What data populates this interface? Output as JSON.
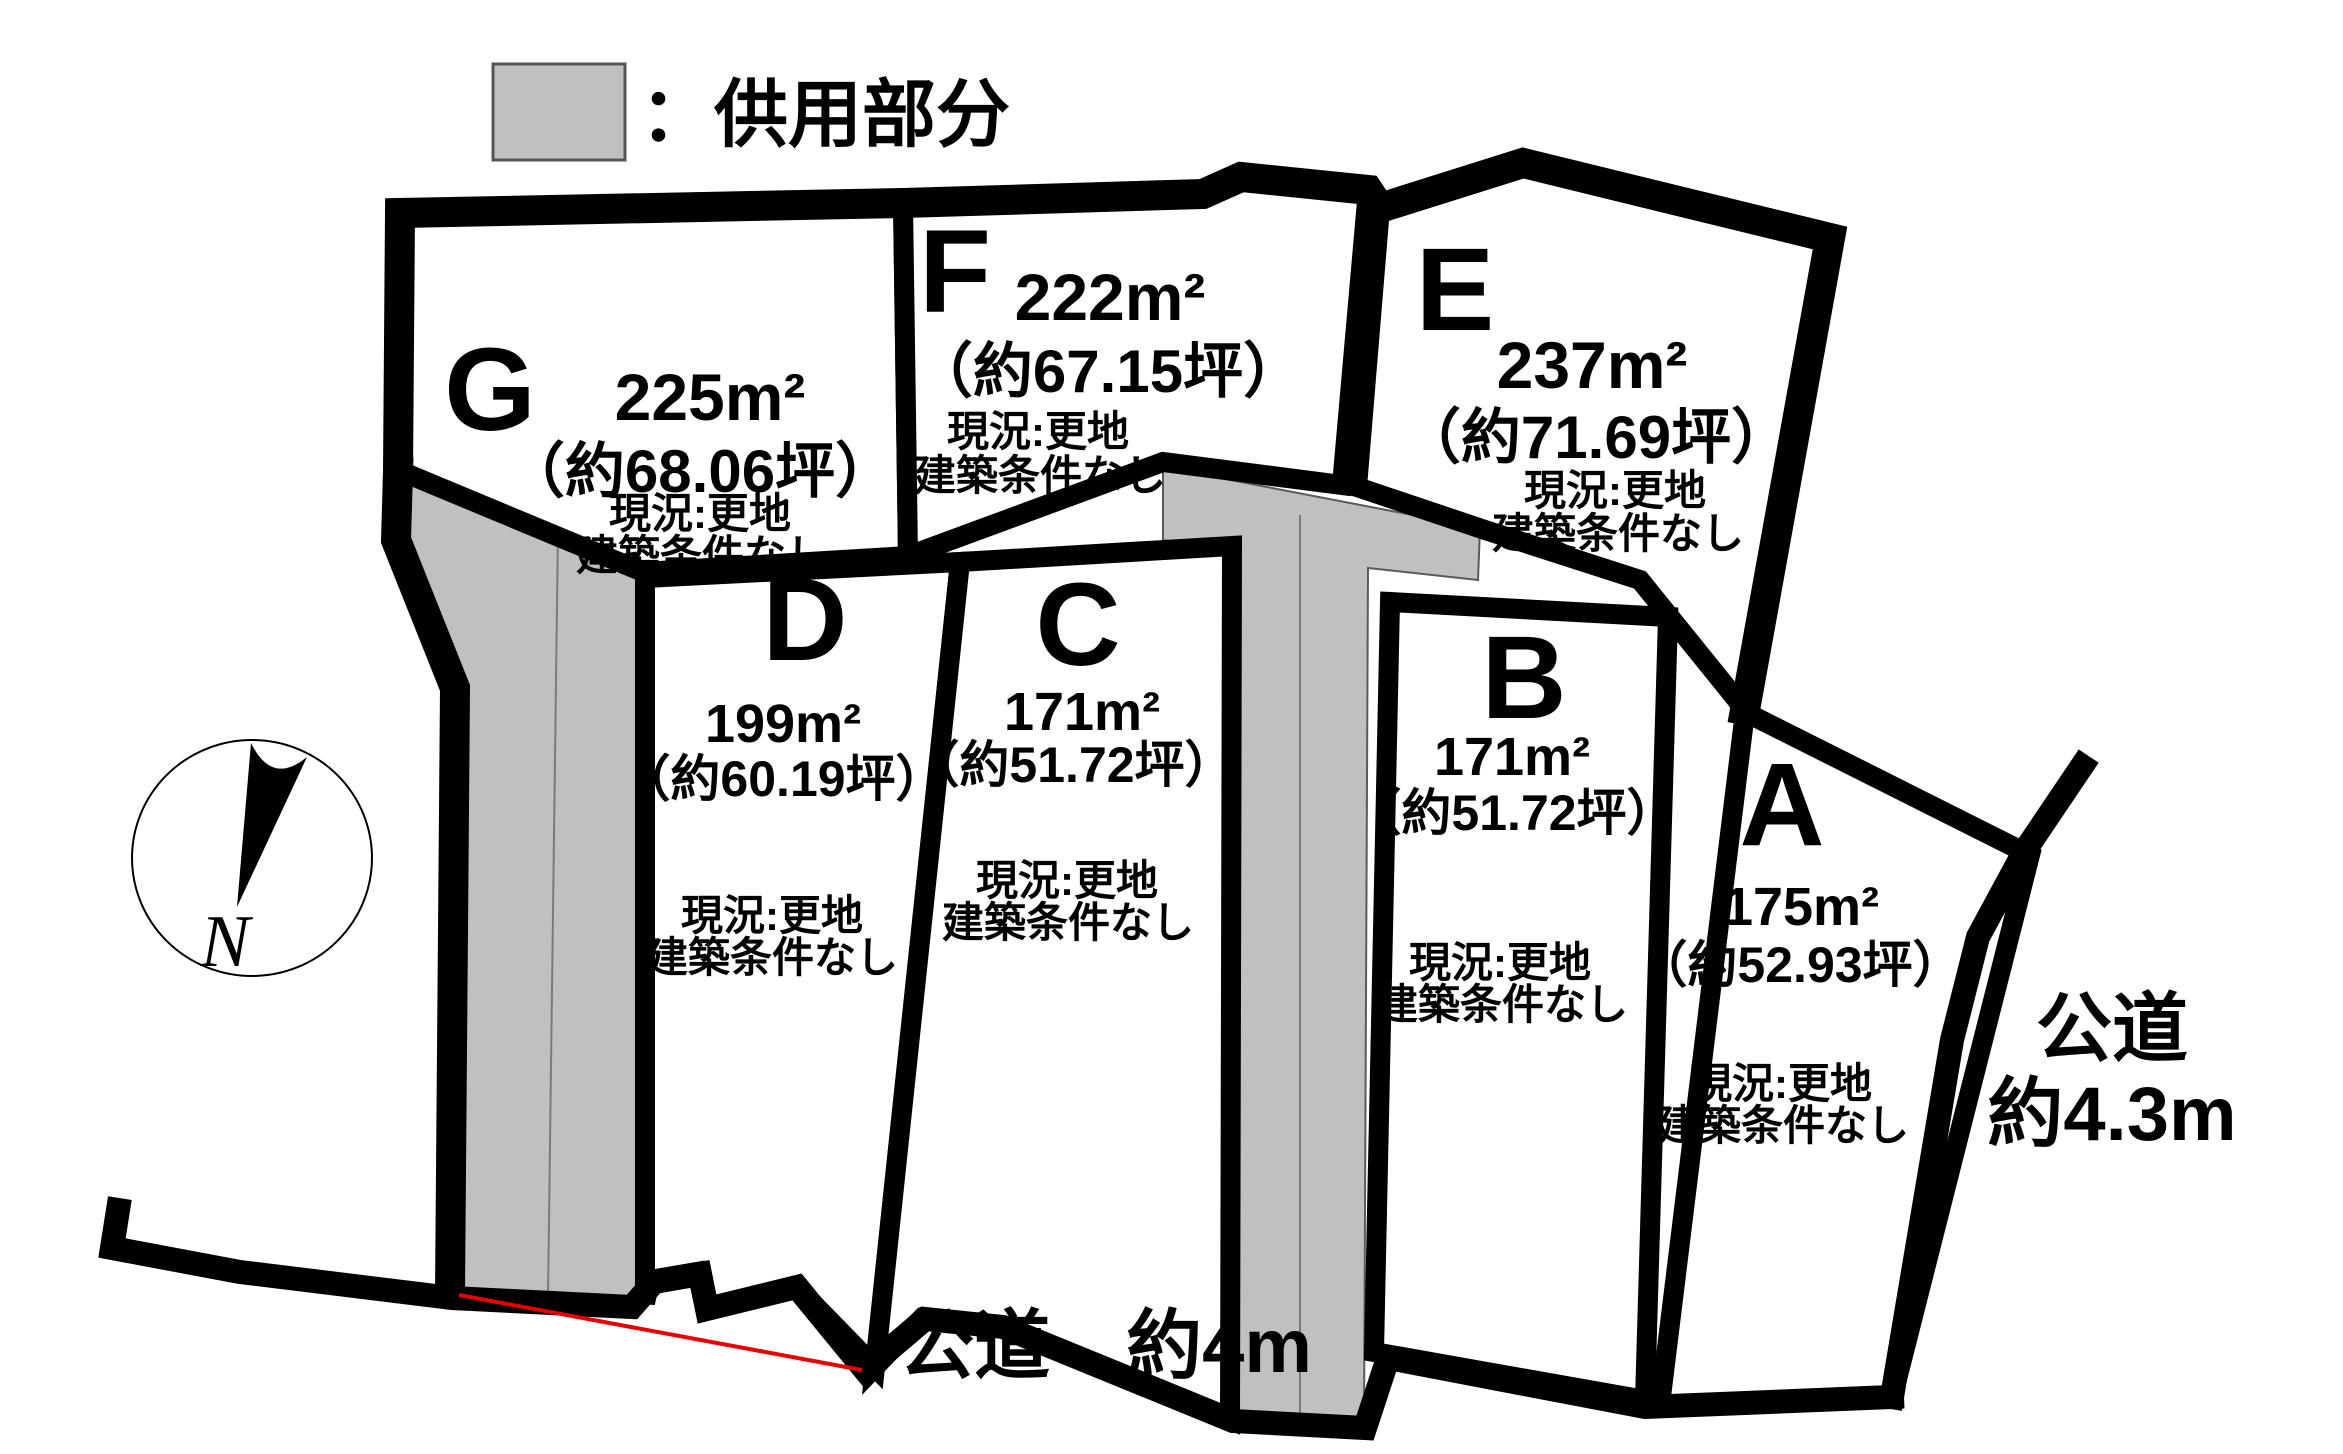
{
  "legend": {
    "label": "：供用部分"
  },
  "compass": {
    "label": "N"
  },
  "roads": {
    "bottom_label": "公道　約4m",
    "right_label_line1": "公道",
    "right_label_line2": "約4.3m"
  },
  "lots": [
    {
      "id": "G",
      "area": "225m²",
      "tsubo": "（約68.06坪）",
      "status1": "現況:更地",
      "status2": "建築条件なし"
    },
    {
      "id": "F",
      "area": "222m²",
      "tsubo": "（約67.15坪）",
      "status1": "現況:更地",
      "status2": "建築条件なし"
    },
    {
      "id": "E",
      "area": "237m²",
      "tsubo": "（約71.69坪）",
      "status1": "現況:更地",
      "status2": "建築条件なし"
    },
    {
      "id": "D",
      "area": "199m²",
      "tsubo": "（約60.19坪）",
      "status1": "現況:更地",
      "status2": "建築条件なし"
    },
    {
      "id": "C",
      "area": "171m²",
      "tsubo": "（約51.72坪）",
      "status1": "現況:更地",
      "status2": "建築条件なし"
    },
    {
      "id": "B",
      "area": "171m²",
      "tsubo": "（約51.72坪）",
      "status1": "現況:更地",
      "status2": "建築条件なし"
    },
    {
      "id": "A",
      "area": "175m²",
      "tsubo": "（約52.93坪）",
      "status1": "現況:更地",
      "status2": "建築条件なし"
    }
  ],
  "colors": {
    "shared_area": "#c0c0c0",
    "boundary": "#000000",
    "guide_line": "#e60000",
    "background": "#ffffff"
  }
}
